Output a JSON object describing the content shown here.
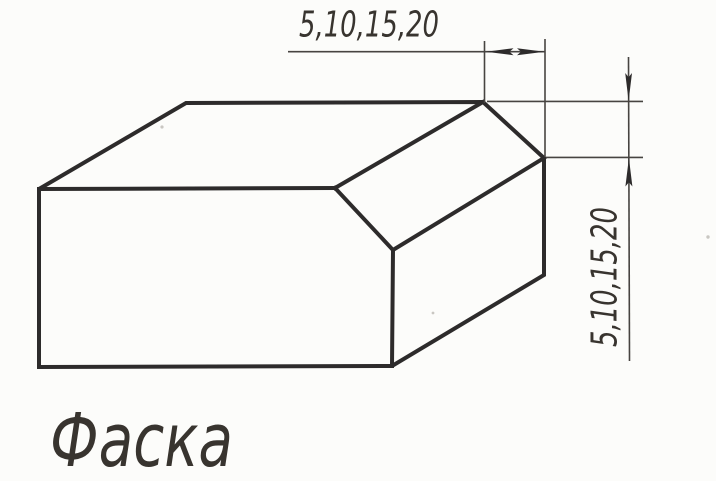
{
  "figure": {
    "type": "technical-drawing",
    "subject": "chamfered-block",
    "caption": "Фаска",
    "dimensions": {
      "top": {
        "label": "5,10,15,20",
        "orientation": "horizontal",
        "measures": "chamfer width across top edge"
      },
      "right": {
        "label": "5,10,15,20",
        "orientation": "vertical",
        "measures": "chamfer height on right edge"
      }
    },
    "colors": {
      "background": "#fcfcfa",
      "edge": "#2d2b2b",
      "thin": "#474441",
      "text": "#38342f"
    }
  }
}
